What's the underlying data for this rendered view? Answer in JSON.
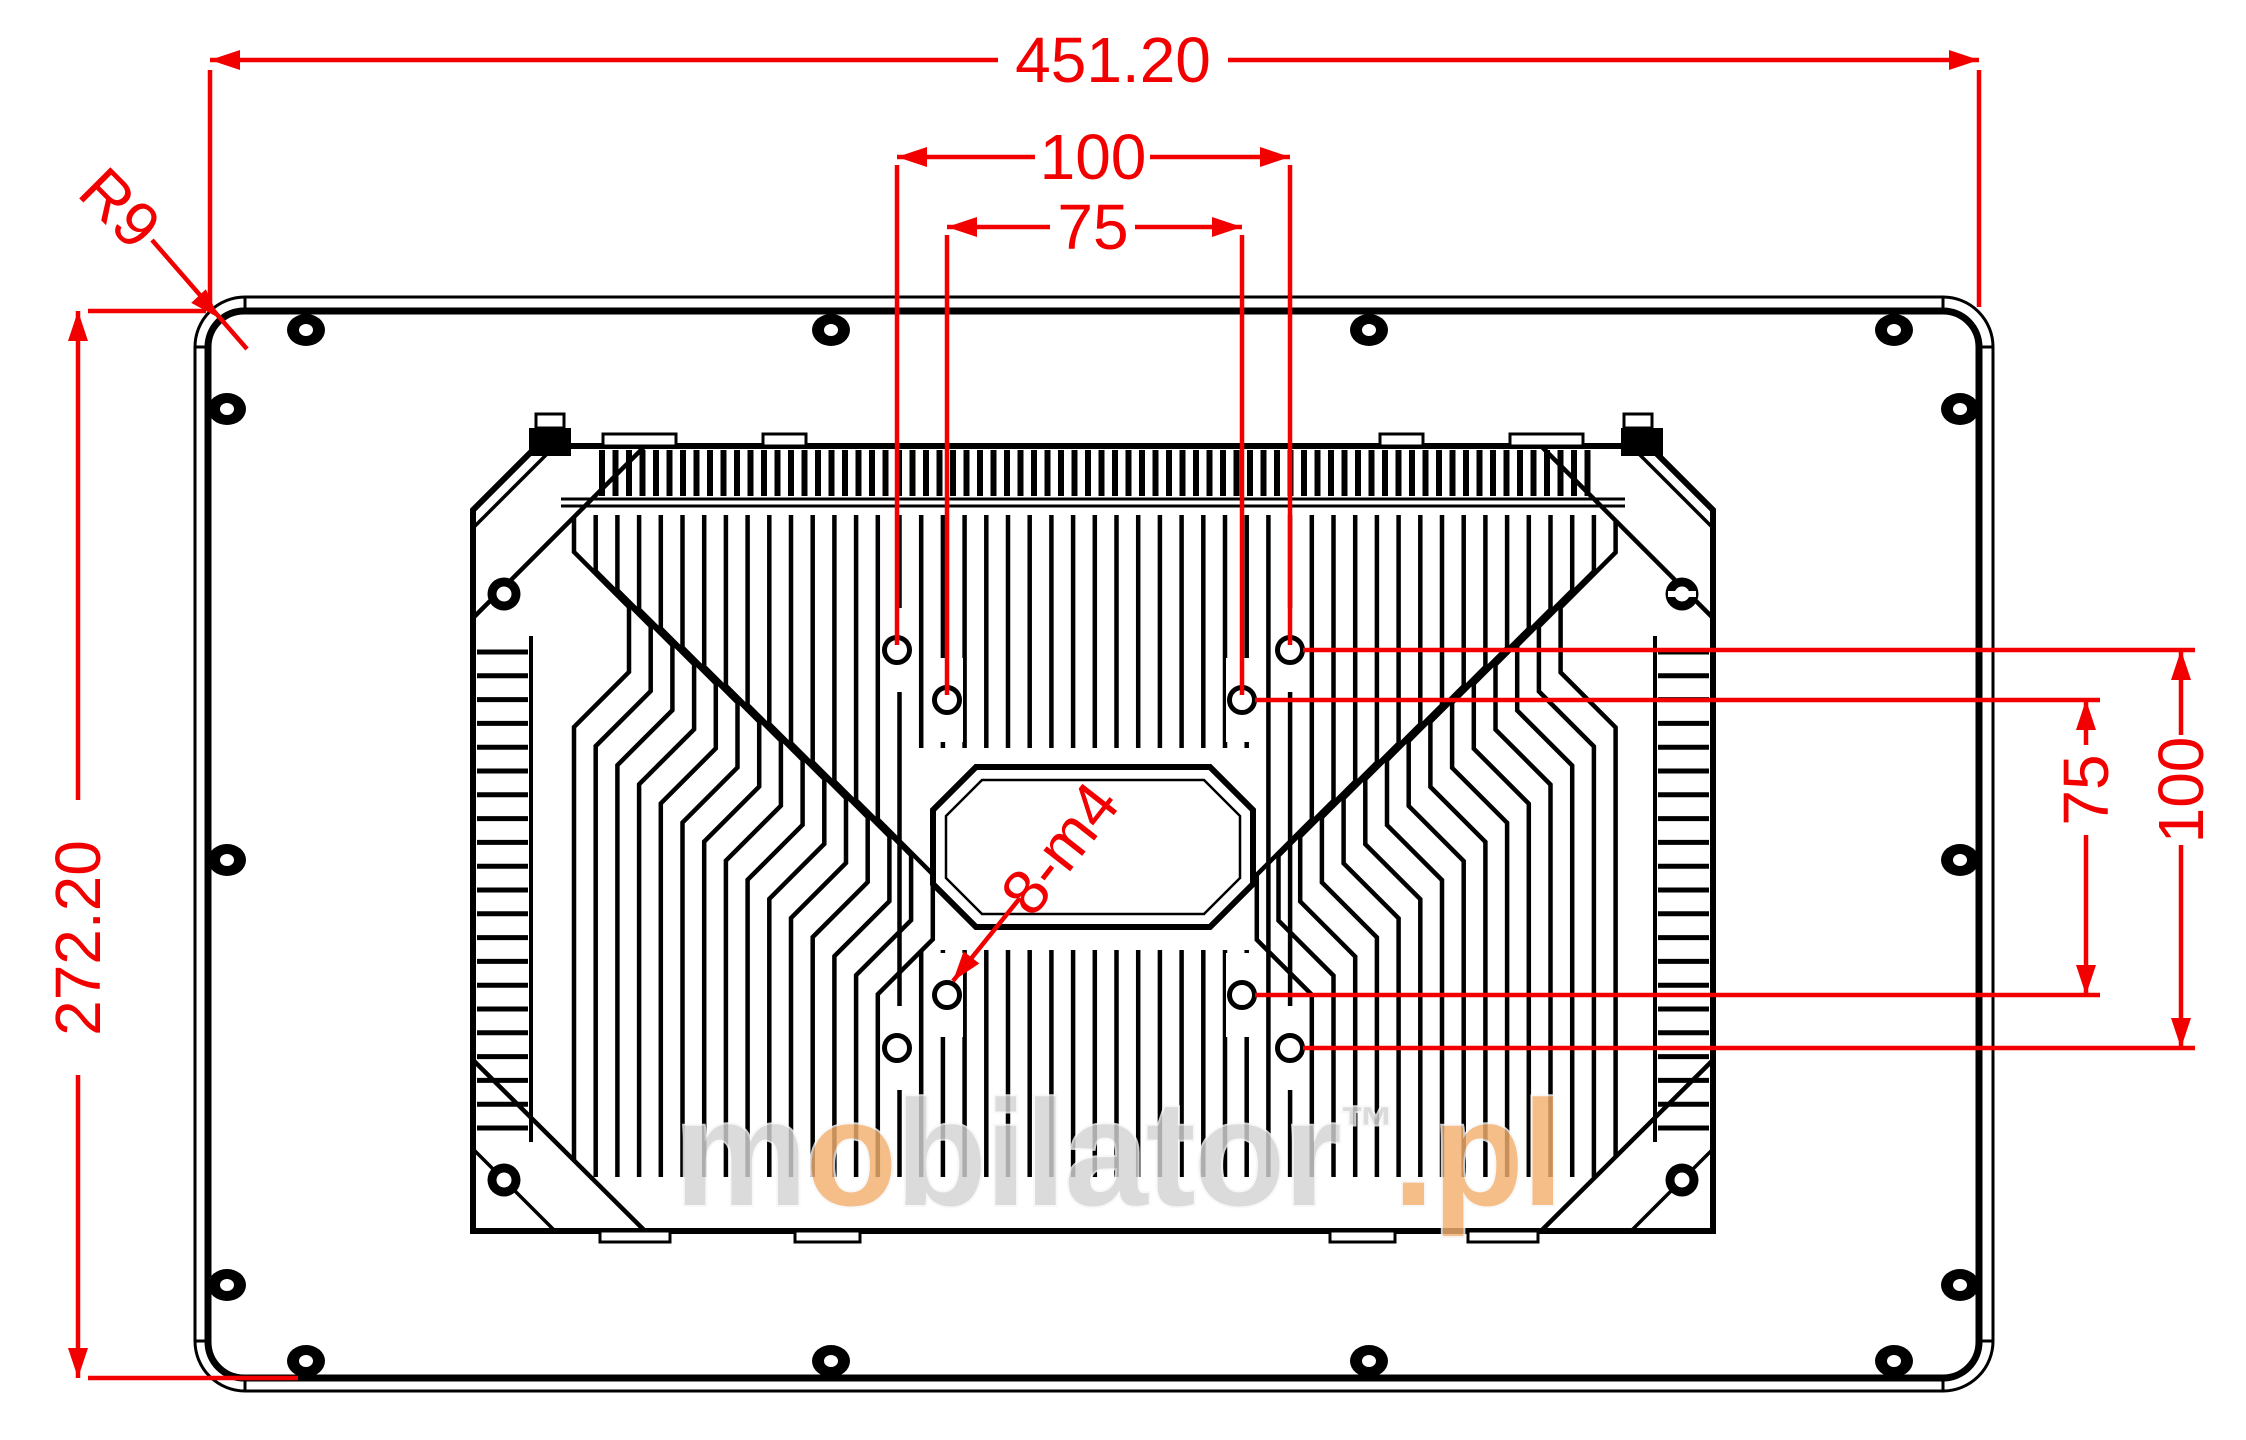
{
  "page": {
    "type": "technical-dimension-drawing",
    "subject": "Rear view of industrial panel PC with heatsink and VESA mounting holes"
  },
  "colors": {
    "background": "#ffffff",
    "line": "#000000",
    "dimension": "#f20000",
    "watermark_gray": "#d4d4d4",
    "watermark_orange": "#f3b070"
  },
  "dims": {
    "width_total": "451.20",
    "vesa_horizontal_100": "100",
    "vesa_horizontal_75": "75",
    "height_total": "272.20",
    "vesa_vertical_75": "75",
    "vesa_vertical_100": "100",
    "corner_radius": "R9",
    "thread_callout": "8-m4"
  },
  "watermark": {
    "part1": "m",
    "part2": "o",
    "part3": "bilator",
    "part4": "™",
    "part5": ".pl"
  }
}
